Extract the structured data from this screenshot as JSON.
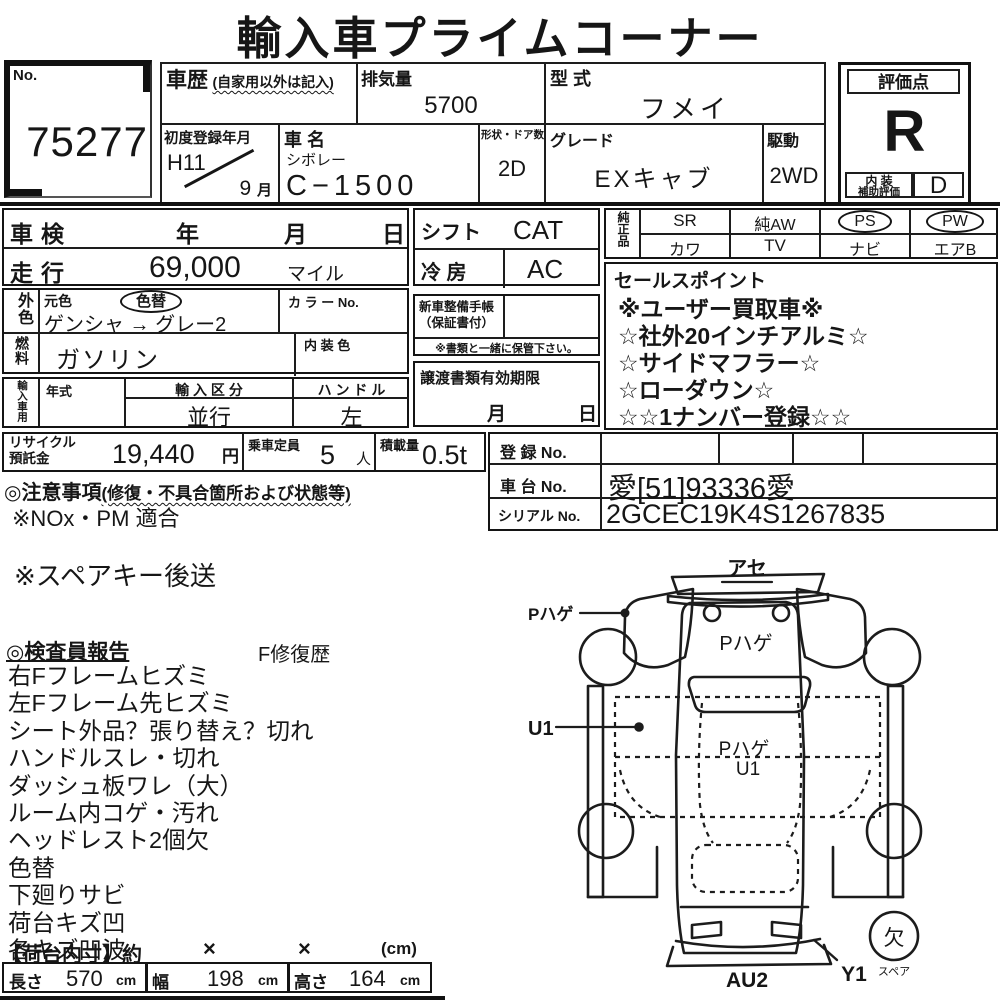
{
  "title": "輸入車プライムコーナー",
  "no_box": {
    "label": "No.",
    "value": "75277"
  },
  "header": {
    "history_label": "車歴",
    "history_note": "(自家用以外は記入)",
    "displacement_label": "排気量",
    "displacement_value": "5700",
    "model_code_label": "型 式",
    "model_code_value": "フメイ",
    "first_reg_label": "初度登録年月",
    "first_reg_year": "H11",
    "first_reg_month": "9",
    "first_reg_month_unit": "月",
    "car_name_label": "車 名",
    "maker": "シボレー",
    "car_name_value": "C−1500",
    "shape_doors_label": "形状・ドア数",
    "shape_doors_value": "2D",
    "grade_label": "グレード",
    "grade_value": "EXキャブ",
    "drive_label": "駆動",
    "drive_value": "2WD"
  },
  "evaluation": {
    "score_label": "評価点",
    "score": "R",
    "interior_label_line1": "内 装",
    "interior_label_line2": "補助評価",
    "interior_score": "D"
  },
  "left_table": {
    "shaken_label": "車検",
    "year_unit": "年",
    "month_unit": "月",
    "day_unit": "日",
    "mileage_label": "走行",
    "mileage_value": "69,000",
    "mileage_unit": "マイル",
    "ext_color_vlabel": "外色",
    "orig_color_label": "元色",
    "color_change_badge": "色替",
    "color_value": "ゲンシャ → グレー2",
    "color_no_label": "カ ラ ー No.",
    "fuel_vlabel": "燃料",
    "fuel_value": "ガソリン",
    "interior_color_label": "内 装 色",
    "import_vlabel": "輸入車用",
    "year_model_label": "年式",
    "import_class_label": "輸 入 区 分",
    "import_class_value": "並行",
    "handle_label": "ハ ン ド ル",
    "handle_value": "左"
  },
  "middle_table": {
    "shift_label": "シフト",
    "shift_value": "CAT",
    "ac_label": "冷 房",
    "ac_value": "AC",
    "service_book_line1": "新車整備手帳",
    "service_book_line2": "（保証書付）",
    "keep_note": "※書類と一緒に保管下さい。",
    "transfer_label": "譲渡書類有効期限",
    "transfer_month": "月",
    "transfer_day": "日"
  },
  "equipment": {
    "vlabel": "純正品",
    "cells_top": [
      "SR",
      "純AW",
      "PS",
      "PW"
    ],
    "cells_bottom": [
      "カワ",
      "TV",
      "ナビ",
      "エアB"
    ]
  },
  "sales_points": {
    "label": "セールスポイント",
    "items": [
      "※ユーザー買取車※",
      "☆社外20インチアルミ☆",
      "☆サイドマフラー☆",
      "☆ローダウン☆",
      "☆☆1ナンバー登録☆☆"
    ]
  },
  "recycle": {
    "label_line1": "リサイクル",
    "label_line2": "預託金",
    "value": "19,440",
    "unit": "円",
    "capacity_label": "乗車定員",
    "capacity_value": "5",
    "capacity_unit": "人",
    "load_label": "積載量",
    "load_value": "0.5t"
  },
  "registration": {
    "reg_label": "登 録 No.",
    "chassis_label": "車 台 No.",
    "chassis_value": "愛[51]93336愛",
    "serial_label": "シリアル No.",
    "serial_value": "2GCEC19K4S1267835"
  },
  "notes": {
    "caution_heading": "◎注意事項",
    "caution_note": "(修復・不具合箇所および状態等)",
    "nox": "※NOx・PM 適合",
    "spare_key": "※スペアキー後送"
  },
  "inspector": {
    "heading": "◎検査員報告",
    "repair_history": "F修復歴",
    "items": [
      "右Fフレームヒズミ",
      "左Fフレーム先ヒズミ",
      "シート外品？張り替え？切れ",
      "ハンドルスレ・切れ",
      "ダッシュ板ワレ（大）",
      "ルーム内コゲ・汚れ",
      "ヘッドレスト2個欠",
      "色替",
      "下廻りサビ",
      "荷台キズ凹",
      "各キズ凹波"
    ]
  },
  "bed_dimensions": {
    "heading": "【荷台内寸】約",
    "x1": "×",
    "x2": "×",
    "unit": "(cm)",
    "length_label": "長さ",
    "length_value": "570",
    "length_unit": "cm",
    "width_label": "幅",
    "width_value": "198",
    "width_unit": "cm",
    "height_label": "高さ",
    "height_value": "164",
    "height_unit": "cm"
  },
  "diagram": {
    "ase": "アセ",
    "p_hage_door": "Pハゲ",
    "p_hage_bed": "Pハゲ",
    "u1_left": "U1",
    "p_hage_cab": "Pハゲ",
    "u1_cab": "U1",
    "au2": "AU2",
    "y1": "Y1",
    "ketsu": "欠",
    "spare": "スペア"
  },
  "colors": {
    "ink": "#161616",
    "paper": "#ffffff"
  }
}
